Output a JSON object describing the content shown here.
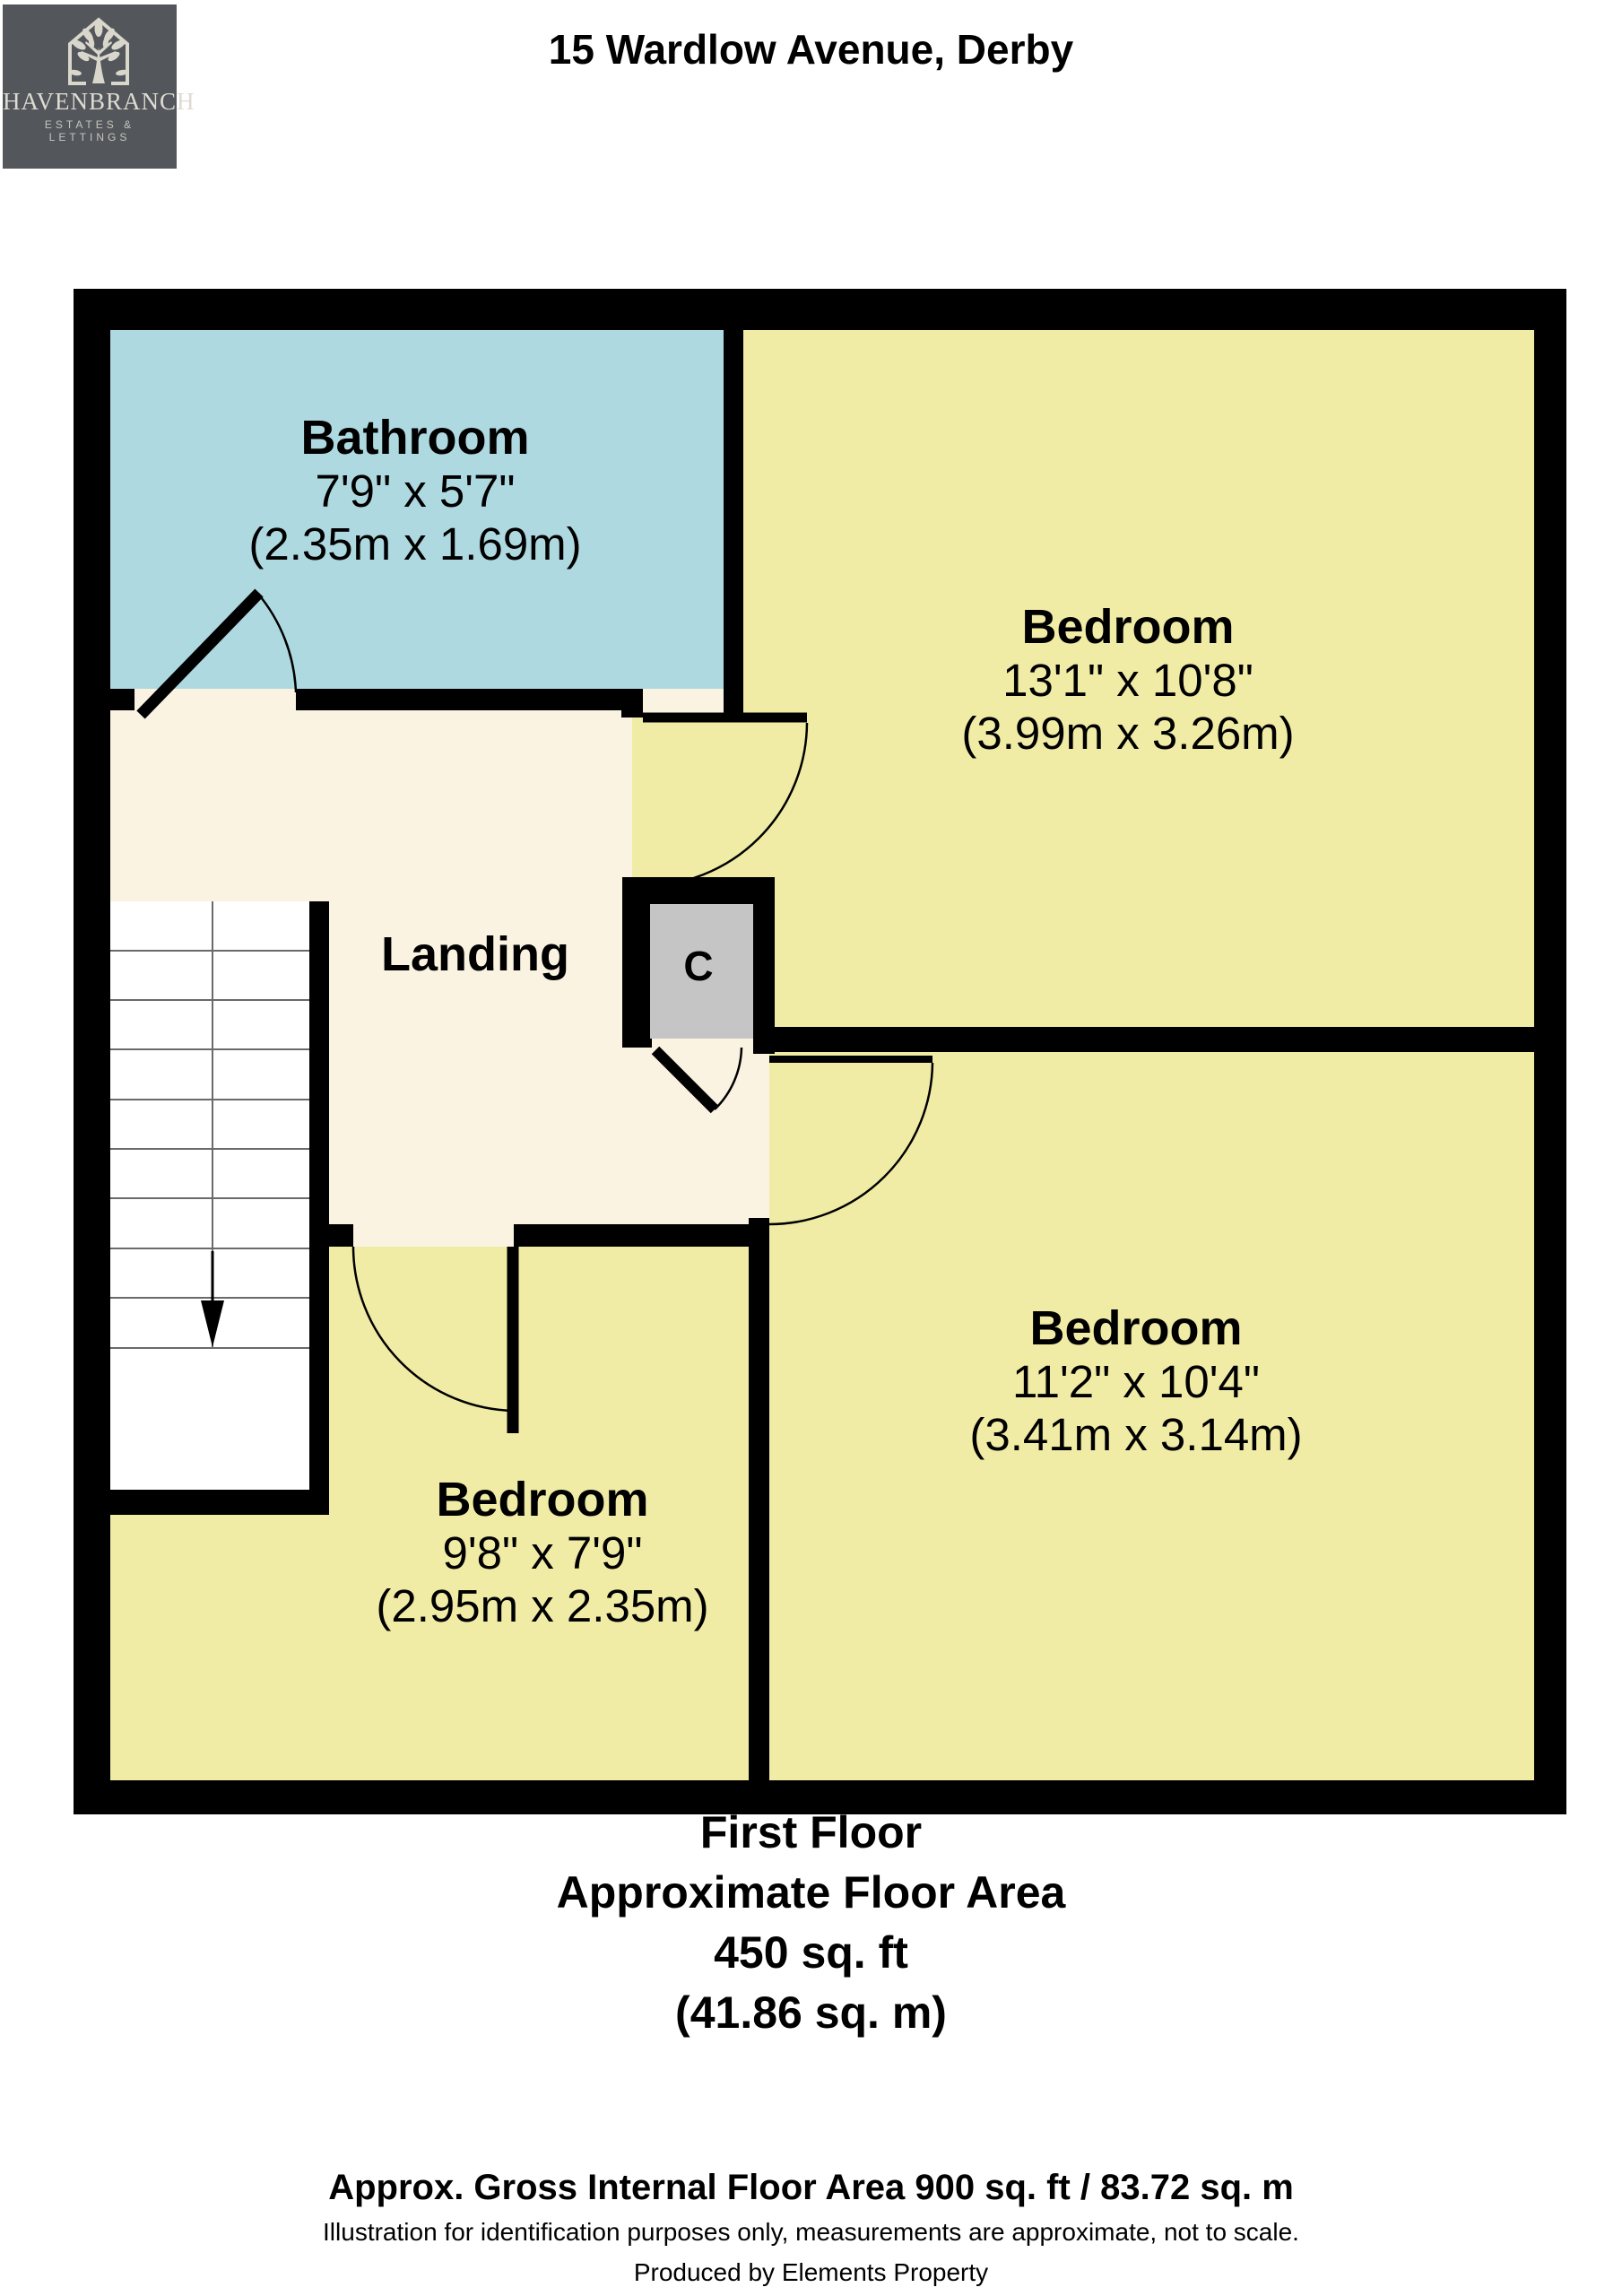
{
  "header": {
    "logo": {
      "brand": "HAVENBRANCH",
      "tagline": "ESTATES & LETTINGS"
    },
    "title": "15 Wardlow Avenue, Derby"
  },
  "floorplan": {
    "rooms": {
      "bathroom": {
        "name": "Bathroom",
        "imperial": "7'9\" x 5'7\"",
        "metric": "(2.35m x 1.69m)"
      },
      "bedroom_top_right": {
        "name": "Bedroom",
        "imperial": "13'1\" x 10'8\"",
        "metric": "(3.99m x 3.26m)"
      },
      "bedroom_bottom_right": {
        "name": "Bedroom",
        "imperial": "11'2\" x 10'4\"",
        "metric": "(3.41m x 3.14m)"
      },
      "bedroom_bottom_left": {
        "name": "Bedroom",
        "imperial": "9'8\" x 7'9\"",
        "metric": "(2.95m x 2.35m)"
      },
      "landing": {
        "name": "Landing"
      },
      "cupboard": {
        "label": "C"
      }
    },
    "colors": {
      "bedroom": "#f1eca5",
      "bathroom": "#aed9e0",
      "landing": "#faf3e2",
      "stairs": "#ffffff",
      "cupboard": "#c5c5c5",
      "wall": "#000000",
      "logo-bg": "#53575c",
      "logo-fg": "#d9d6cb"
    }
  },
  "summary": {
    "lines": [
      "First Floor",
      "Approximate Floor Area",
      "450 sq. ft",
      "(41.86 sq. m)"
    ]
  },
  "footer": {
    "gross_area": "Approx. Gross Internal Floor Area 900 sq. ft / 83.72 sq. m",
    "disclaimer": "Illustration for identification purposes only, measurements are approximate, not to scale.",
    "produced_by": "Produced by Elements Property"
  }
}
